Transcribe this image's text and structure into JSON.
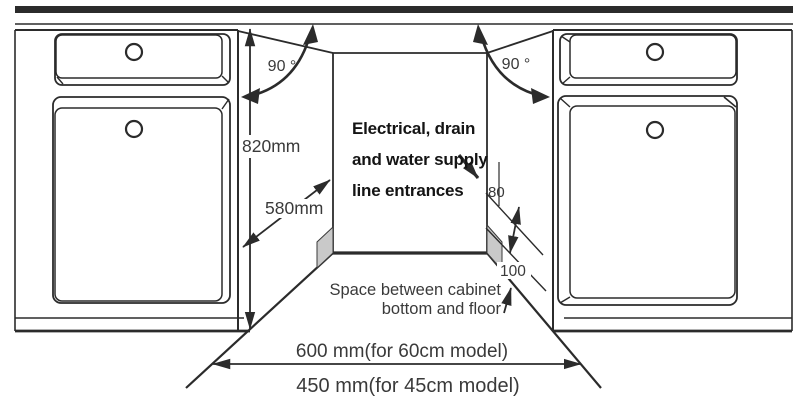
{
  "diagram": {
    "type": "built-in-appliance-cabinet-installation-diagram",
    "annotations": {
      "left_angle": "90 °",
      "right_angle": "90 °",
      "height": "820mm",
      "depth": "580mm",
      "entrance_offset": "80",
      "bottom_space": "100",
      "width_60cm": "600 mm(for 60cm model)",
      "width_45cm": "450 mm(for 45cm model)"
    },
    "notes": {
      "entrances": [
        "Electrical, drain",
        "and water supply",
        "line entrances"
      ],
      "floor_space": [
        "Space between cabinet",
        "bottom and floor"
      ]
    },
    "colors": {
      "line": "#2b2b2b",
      "dimension_text": "#3a3a3a",
      "note_text": "#141414",
      "shade": "#c9c9c9",
      "background": "#ffffff"
    }
  }
}
